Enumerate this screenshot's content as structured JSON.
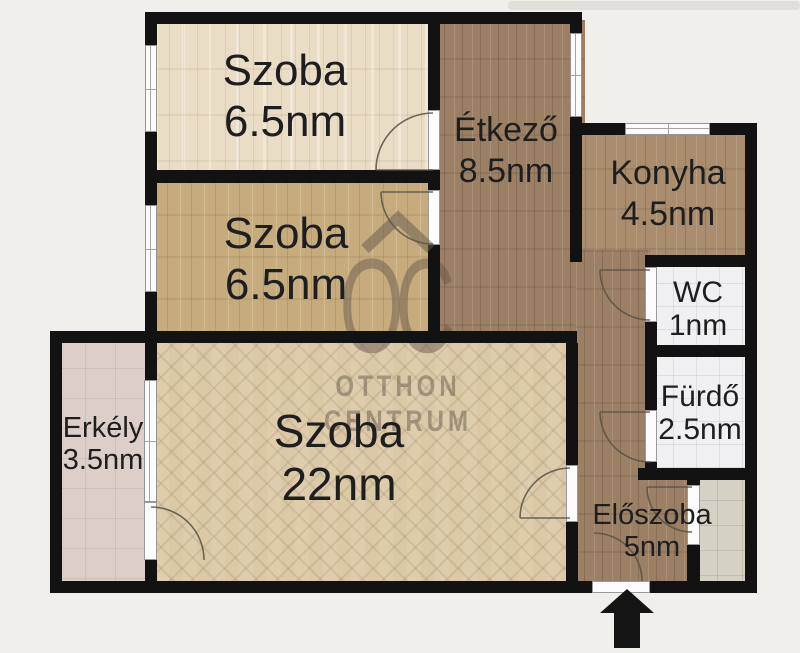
{
  "plan_title": "apartment-floor-plan",
  "rooms": {
    "szoba1": {
      "name": "Szoba",
      "area": "6.5nm"
    },
    "szoba2": {
      "name": "Szoba",
      "area": "6.5nm"
    },
    "etkezo": {
      "name": "Étkező",
      "area": "8.5nm"
    },
    "konyha": {
      "name": "Konyha",
      "area": "4.5nm"
    },
    "wc": {
      "name": "WC",
      "area": "1nm"
    },
    "furdo": {
      "name": "Fürdő",
      "area": "2.5nm"
    },
    "eloszoba": {
      "name": "Előszoba",
      "area": "5nm"
    },
    "erkely": {
      "name": "Erkély",
      "area": "3.5nm"
    },
    "nagyszoba": {
      "name": "Szoba",
      "area": "22nm"
    }
  },
  "watermark": {
    "monogram": "OC",
    "line1": "OTTHON",
    "line2": "CENTRUM"
  },
  "colors": {
    "background": "#f1efeb",
    "wall": "#121212",
    "floor_wood_light": "#e9ddc5",
    "floor_wood_tan": "#c6ab7d",
    "floor_wood_brown": "#9c8065",
    "floor_wood_kitchen": "#a98d6e",
    "floor_parquet": "#dac8a7",
    "tile_balcony": "#dccfca",
    "tile_bath": "#f0f0f2",
    "tile_pantry": "#d6d1c5",
    "watermark": "#64584a"
  }
}
